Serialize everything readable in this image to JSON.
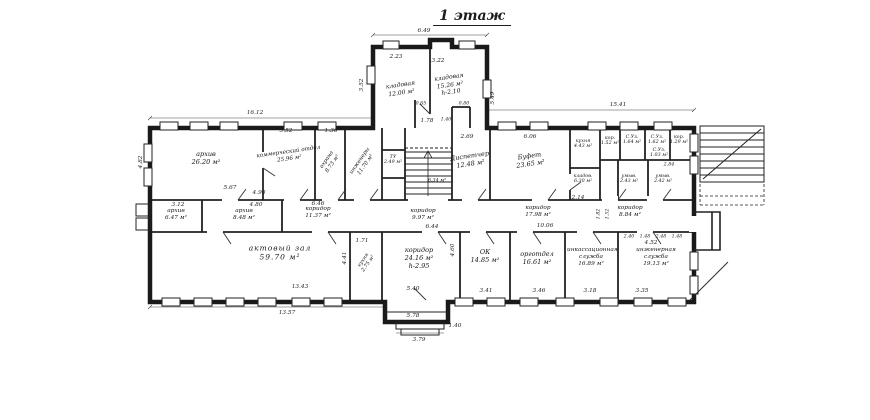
{
  "title": "1 этаж",
  "colors": {
    "ink": "#1d1d1d",
    "paper": "#ffffff"
  },
  "rooms": [
    {
      "name": "архив",
      "area": "26.20 м²"
    },
    {
      "name": "коммерческий отдел",
      "area": "25.96 м²"
    },
    {
      "name": "охрана",
      "area": "8.73 м²"
    },
    {
      "name": "инженеры",
      "area": "11.70 м²"
    },
    {
      "name": "ТУ",
      "area": "2.49 м²"
    },
    {
      "name": "",
      "area": "6.34 м²"
    },
    {
      "name": "Диспетчер",
      "area": "12.48 м²"
    },
    {
      "name": "Буфет",
      "area": "23.65 м²"
    },
    {
      "name": "кухня",
      "area": "4.43 м²"
    },
    {
      "name": "кор.",
      "area": "1.52 м²"
    },
    {
      "name": "С.Уз.",
      "area": "1.64 м²"
    },
    {
      "name": "С.Уз.",
      "area": "1.62 м²"
    },
    {
      "name": "кор.",
      "area": "1.29 м²"
    },
    {
      "name": "С.Уз.",
      "area": "1.03 м²"
    },
    {
      "name": "кладов.",
      "area": "6.30 м²"
    },
    {
      "name": "умыв.",
      "area": "2.43 м²"
    },
    {
      "name": "умыв.",
      "area": "2.42 м²"
    },
    {
      "name": "",
      "area": "2.84"
    },
    {
      "name": "кладовая",
      "area": "12.00 м²"
    },
    {
      "name": "кладовая",
      "area": "15.26 м²",
      "h": "h-2.10"
    },
    {
      "name": "архив",
      "area": "6.47 м²"
    },
    {
      "name": "архив",
      "area": "8.48 м²"
    },
    {
      "name": "коридор",
      "area": "11.37 м²"
    },
    {
      "name": "коридор",
      "area": "9.97 м²"
    },
    {
      "name": "коридор",
      "area": "17.98 м²"
    },
    {
      "name": "коридор",
      "area": "8.84 м²"
    },
    {
      "name": "актовый зал",
      "area": "59.70 м²"
    },
    {
      "name": "кухня",
      "area": "2.75 м²"
    },
    {
      "name": "коридор",
      "area": "24.16 м²",
      "h": "h-2.95"
    },
    {
      "name": "ОК",
      "area": "14.85 м²"
    },
    {
      "name": "орготдел",
      "area": "16.61 м²"
    },
    {
      "name": "инкассационная служба",
      "area": "16.89 м²"
    },
    {
      "name": "инженерная служба",
      "area": "19.13 м²"
    }
  ],
  "dims": [
    "16.12",
    "5.52",
    "1.36",
    "6.49",
    "2.23",
    "3.22",
    "3.52",
    "5.49",
    "1.78",
    "15.41",
    "4.82",
    "5.67",
    "4.90",
    "3.12",
    "4.80",
    "6.46",
    "6.44",
    "10.06",
    "2.14",
    "4.52",
    "2.69",
    "6.06",
    "4.41",
    "4.60",
    "1.71",
    "13.43",
    "13.57",
    "5.40",
    "5.78",
    "3.79",
    "1.40",
    "3.41",
    "3.46",
    "3.18",
    "3.35",
    "2.40",
    "1.48",
    "2.48",
    "1.48",
    "0.65",
    "1.40",
    "0.80",
    "1.82",
    "1.52"
  ]
}
